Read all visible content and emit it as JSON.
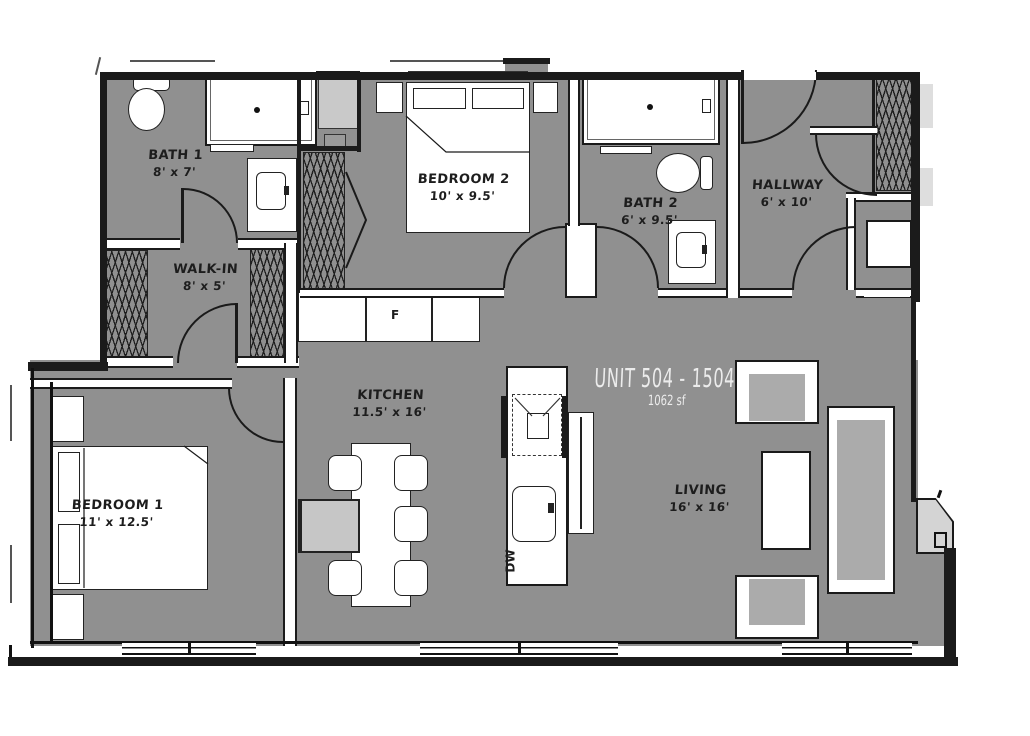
{
  "unit": {
    "title": "UNIT 504 - 1504",
    "area": "1062 sf"
  },
  "rooms": {
    "bath1": {
      "name": "BATH 1",
      "dims": "8' x 7'"
    },
    "walkin": {
      "name": "WALK-IN",
      "dims": "8' x 5'"
    },
    "bedroom2": {
      "name": "BEDROOM 2",
      "dims": "10' x 9.5'"
    },
    "bath2": {
      "name": "BATH 2",
      "dims": "6' x 9.5'"
    },
    "hallway": {
      "name": "HALLWAY",
      "dims": "6' x 10'"
    },
    "kitchen": {
      "name": "KITCHEN",
      "dims": "11.5' x 16'"
    },
    "bedroom1": {
      "name": "BEDROOM 1",
      "dims": "11' x 12.5'"
    },
    "living": {
      "name": "LIVING",
      "dims": "16' x 16'"
    }
  },
  "appliances": {
    "fridge": "F",
    "dishwasher": "DW"
  },
  "colors": {
    "floor": "#909090",
    "wall": "#1b1b1b",
    "fixture": "#ffffff",
    "cushion": "#ababab",
    "panel": "#c9c9c9",
    "unit_label": "#ececec",
    "room_label": "#1d1d1d"
  }
}
